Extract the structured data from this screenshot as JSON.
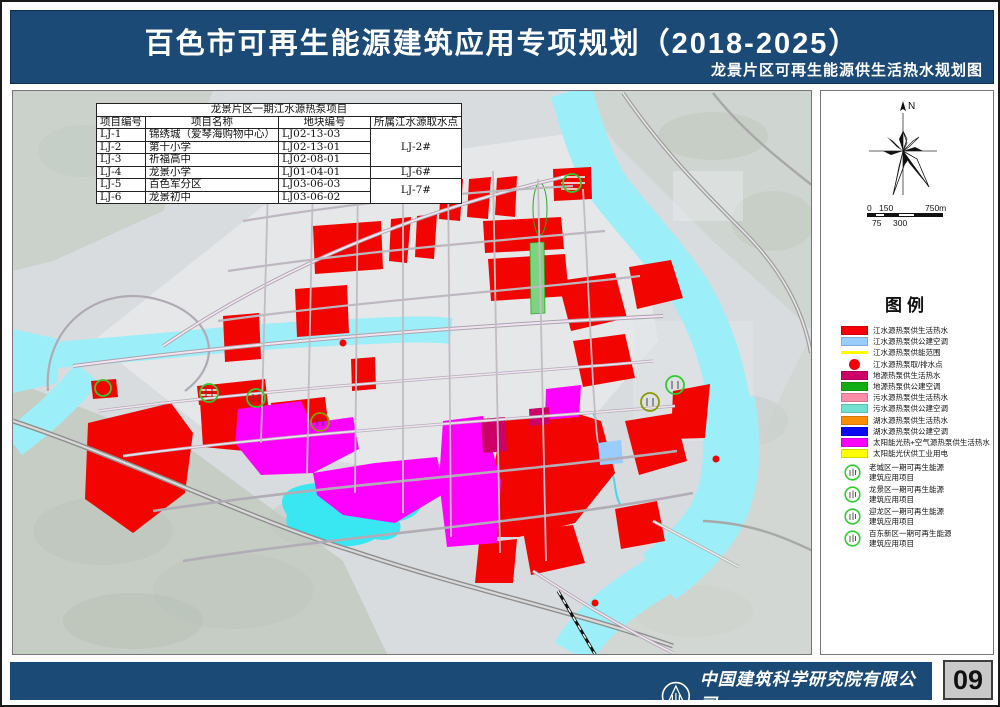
{
  "header": {
    "title": "百色市可再生能源建筑应用专项规划（2018-2025）",
    "subtitle": "龙景片区可再生能源供生活热水规划图",
    "bar_color": "#1b4a76"
  },
  "map": {
    "table": {
      "title": "龙景片区一期江水源热泵项目",
      "headers": [
        "项目编号",
        "项目名称",
        "地块编号",
        "所属江水源取水点"
      ],
      "rows": [
        {
          "code": "LJ-1",
          "name": "锦绣城（爱琴海购物中心）",
          "block": "LJ02-13-03",
          "intake": {
            "label": "LJ-2#",
            "rowspan": 3
          }
        },
        {
          "code": "LJ-2",
          "name": "第十小学",
          "block": "LJ02-13-01",
          "intake": null
        },
        {
          "code": "LJ-3",
          "name": "祈福高中",
          "block": "LJ02-08-01",
          "intake": null
        },
        {
          "code": "LJ-4",
          "name": "龙景小学",
          "block": "LJ01-04-01",
          "intake": {
            "label": "LJ-6#",
            "rowspan": 1
          }
        },
        {
          "code": "LJ-5",
          "name": "百色军分区",
          "block": "LJ03-06-03",
          "intake": {
            "label": "LJ-7#",
            "rowspan": 2
          }
        },
        {
          "code": "LJ-6",
          "name": "龙景初中",
          "block": "LJ03-06-02",
          "intake": null
        }
      ]
    },
    "colors": {
      "river": "#9ceef8",
      "lake": "#38e7f2",
      "zone_red": "#f20500",
      "zone_magenta": "#ff00ff",
      "zone_crimson": "#cc0066",
      "zone_green": "#12ad12",
      "zone_lightblue": "#99ccff",
      "marker_green": "#2ecc2e"
    }
  },
  "panel": {
    "north_label": "N",
    "scale": {
      "label_0": "0",
      "label_150": "150",
      "label_750": "750m",
      "label_75": "75",
      "label_300": "300"
    },
    "legend_title": "图例",
    "legend_items": [
      {
        "type": "rect",
        "color": "#f50008",
        "label": "江水源热泵供生活热水"
      },
      {
        "type": "rect",
        "color": "#99ccff",
        "label": "江水源热泵供公建空调"
      },
      {
        "type": "line",
        "color": "#ffff00",
        "label": "江水源热泵供能范围"
      },
      {
        "type": "circle",
        "color": "#f50008",
        "label": "江水源热泵取/排水点"
      },
      {
        "type": "rect",
        "color": "#cc0066",
        "label": "地源热泵供生活热水"
      },
      {
        "type": "rect",
        "color": "#12ad12",
        "label": "地源热泵供公建空调"
      },
      {
        "type": "rect",
        "color": "#fb8da8",
        "label": "污水源热泵供生活热水"
      },
      {
        "type": "rect",
        "color": "#70e0d0",
        "label": "污水源热泵供公建空调"
      },
      {
        "type": "rect",
        "color": "#f88d0a",
        "label": "湖水源热泵供生活热水"
      },
      {
        "type": "rect",
        "color": "#0a0af0",
        "label": "湖水源热泵供公建空调"
      },
      {
        "type": "rect",
        "color": "#ff00ff",
        "label": "太阳能光热+空气源热泵供生活热水"
      },
      {
        "type": "rect",
        "color": "#ffff00",
        "label": "太阳能光伏供工业用电"
      }
    ],
    "legend_icons": [
      {
        "line1": "老城区一期可再生能源",
        "line2": "建筑应用项目"
      },
      {
        "line1": "龙景区一期可再生能源",
        "line2": "建筑应用项目"
      },
      {
        "line1": "迎龙区一期可再生能源",
        "line2": "建筑应用项目"
      },
      {
        "line1": "百东新区一期可再生能源",
        "line2": "建筑应用项目"
      }
    ]
  },
  "footer": {
    "company_cn": "中国建筑科学研究院有限公司",
    "company_en": "China Academy of Building Research",
    "page_number": "09"
  }
}
